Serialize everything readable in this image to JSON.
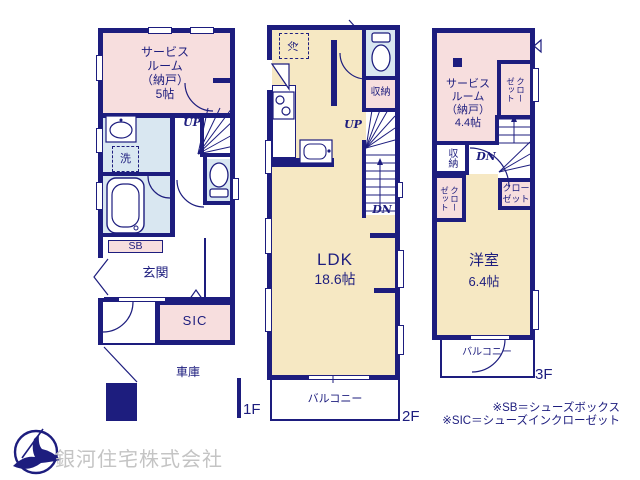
{
  "colors": {
    "wall": "#1d1d7e",
    "room_pink": "#f7dede",
    "room_cream": "#f6e8c3",
    "room_blue": "#d9e7f1",
    "company_gray": "#c4c4c4"
  },
  "floor1": {
    "floor_label": "1F",
    "service_room": "サービス\nルーム\n（納戸）\n5帖",
    "wash": "洗",
    "up": "UP",
    "sb": "SB",
    "entrance": "玄関",
    "sic": "SIC",
    "garage": "車庫"
  },
  "floor2": {
    "floor_label": "2F",
    "fridge": "冷",
    "storage": "収納",
    "up": "UP",
    "dn": "DN",
    "ldk": "LDK",
    "ldk_size": "18.6帖",
    "balcony": "バルコニー"
  },
  "floor3": {
    "floor_label": "3F",
    "service_room": "サービス\nルーム\n（納戸）\n4.4帖",
    "closet_top": "クロー\nゼット",
    "storage": "収納",
    "dn": "DN",
    "closet_left": "クロー\nゼット",
    "closet_right": "クロー\nゼット",
    "western_room": "洋室",
    "western_room_size": "6.4帖",
    "balcony": "バルコニー"
  },
  "legend": {
    "sb_note": "※SB＝シューズボックス",
    "sic_note": "※SIC＝シューズインクローゼット"
  },
  "company": {
    "name": "銀河住宅株式会社"
  }
}
